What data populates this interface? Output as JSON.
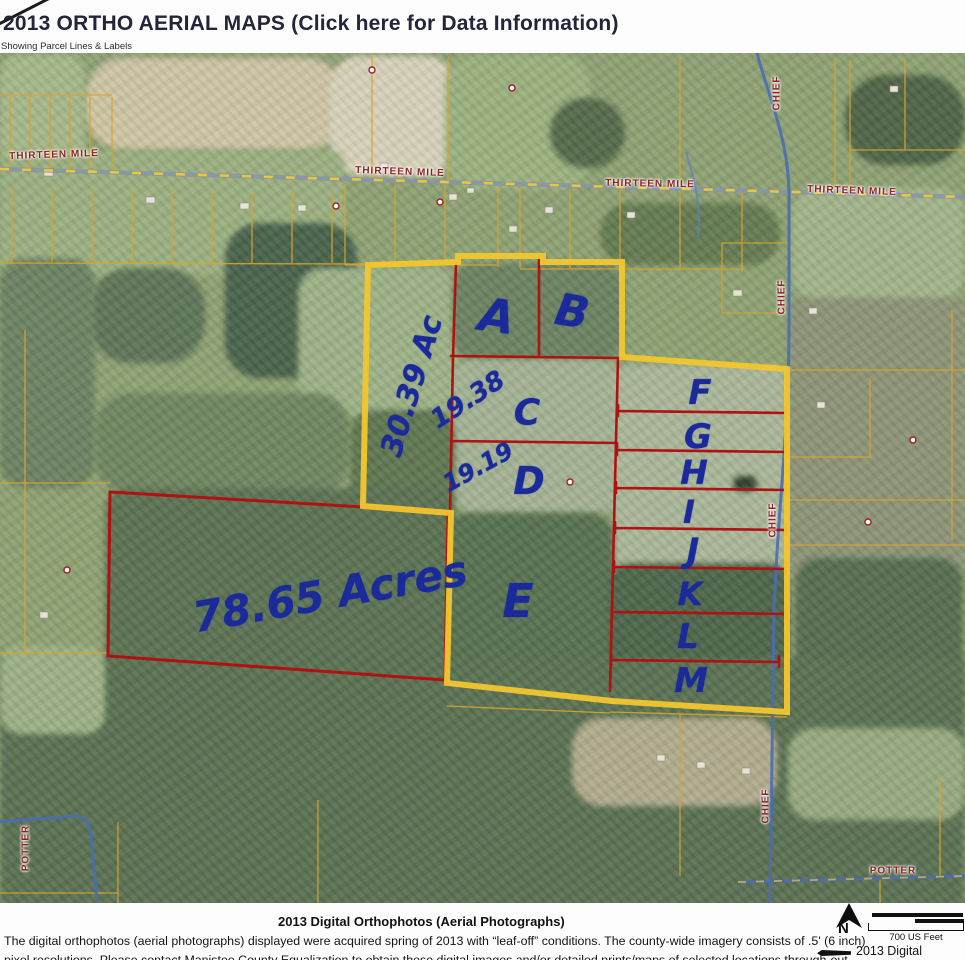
{
  "colors": {
    "yellow": "#f2c62e",
    "red": "#b01111",
    "ink": "#1b2a9b",
    "roadlabel": "#8e2222",
    "thinline": "#d8a52c",
    "roadblue": "#4a6db3"
  },
  "header": {
    "title": "2013 ORTHO AERIAL MAPS (Click here for Data Information)",
    "subtitle": "Showing Parcel Lines & Labels"
  },
  "map": {
    "road_labels": [
      {
        "text": "THIRTEEN MILE",
        "x": 54,
        "y": 155,
        "rot": -2
      },
      {
        "text": "THIRTEEN MILE",
        "x": 400,
        "y": 172,
        "rot": 2
      },
      {
        "text": "THIRTEEN MILE",
        "x": 650,
        "y": 184,
        "rot": 1
      },
      {
        "text": "THIRTEEN MILE",
        "x": 852,
        "y": 191,
        "rot": 2
      },
      {
        "text": "CHIEF",
        "x": 777,
        "y": 93,
        "rot": -90
      },
      {
        "text": "CHIEF",
        "x": 782,
        "y": 297,
        "rot": -90
      },
      {
        "text": "CHIEF",
        "x": 773,
        "y": 520,
        "rot": -90
      },
      {
        "text": "CHIEF",
        "x": 766,
        "y": 806,
        "rot": -90
      },
      {
        "text": "POTTER",
        "x": 26,
        "y": 848,
        "rot": -90
      },
      {
        "text": "POTTER",
        "x": 893,
        "y": 871,
        "rot": 0
      }
    ],
    "parcel_annotations": [
      {
        "text": "30.39 Ac",
        "x": 412,
        "y": 386,
        "rot": -73,
        "size": 30
      },
      {
        "text": "A",
        "x": 497,
        "y": 316,
        "rot": 8,
        "size": 46
      },
      {
        "text": "B",
        "x": 572,
        "y": 312,
        "rot": 10,
        "size": 44
      },
      {
        "text": "19.38",
        "x": 468,
        "y": 400,
        "rot": -33,
        "size": 26
      },
      {
        "text": "C",
        "x": 527,
        "y": 413,
        "rot": 0,
        "size": 36
      },
      {
        "text": "19.19",
        "x": 478,
        "y": 467,
        "rot": -29,
        "size": 24
      },
      {
        "text": "D",
        "x": 529,
        "y": 481,
        "rot": 0,
        "size": 38
      },
      {
        "text": "E",
        "x": 518,
        "y": 601,
        "rot": 0,
        "size": 46
      },
      {
        "text": "78.65 Acres",
        "x": 330,
        "y": 594,
        "rot": -10,
        "size": 42
      },
      {
        "text": "F",
        "x": 700,
        "y": 393,
        "rot": 0,
        "size": 34
      },
      {
        "text": "G",
        "x": 698,
        "y": 437,
        "rot": 0,
        "size": 34
      },
      {
        "text": "H",
        "x": 694,
        "y": 472,
        "rot": 0,
        "size": 33
      },
      {
        "text": "I",
        "x": 689,
        "y": 512,
        "rot": 0,
        "size": 32
      },
      {
        "text": "J",
        "x": 693,
        "y": 551,
        "rot": 0,
        "size": 34
      },
      {
        "text": "K",
        "x": 690,
        "y": 594,
        "rot": 0,
        "size": 32
      },
      {
        "text": "L",
        "x": 688,
        "y": 637,
        "rot": 0,
        "size": 34
      },
      {
        "text": "M",
        "x": 691,
        "y": 681,
        "rot": 0,
        "size": 34
      }
    ]
  },
  "footer": {
    "title": "2013 Digital Orthophotos (Aerial Photographs)",
    "body_line1": "The digital orthophotos (aerial photographs) displayed were acquired spring of 2013 with “leaf-off” conditions. The county-wide imagery consists of .5' (6 inch)",
    "body_line2": "pixel resolutions. Please contact Manistee County Equalization to obtain these digital images and/or detailed prints/maps of selected locations through-out",
    "north_label": "N",
    "scale_label": "700 US Feet",
    "legend_label": "2013 Digital"
  }
}
